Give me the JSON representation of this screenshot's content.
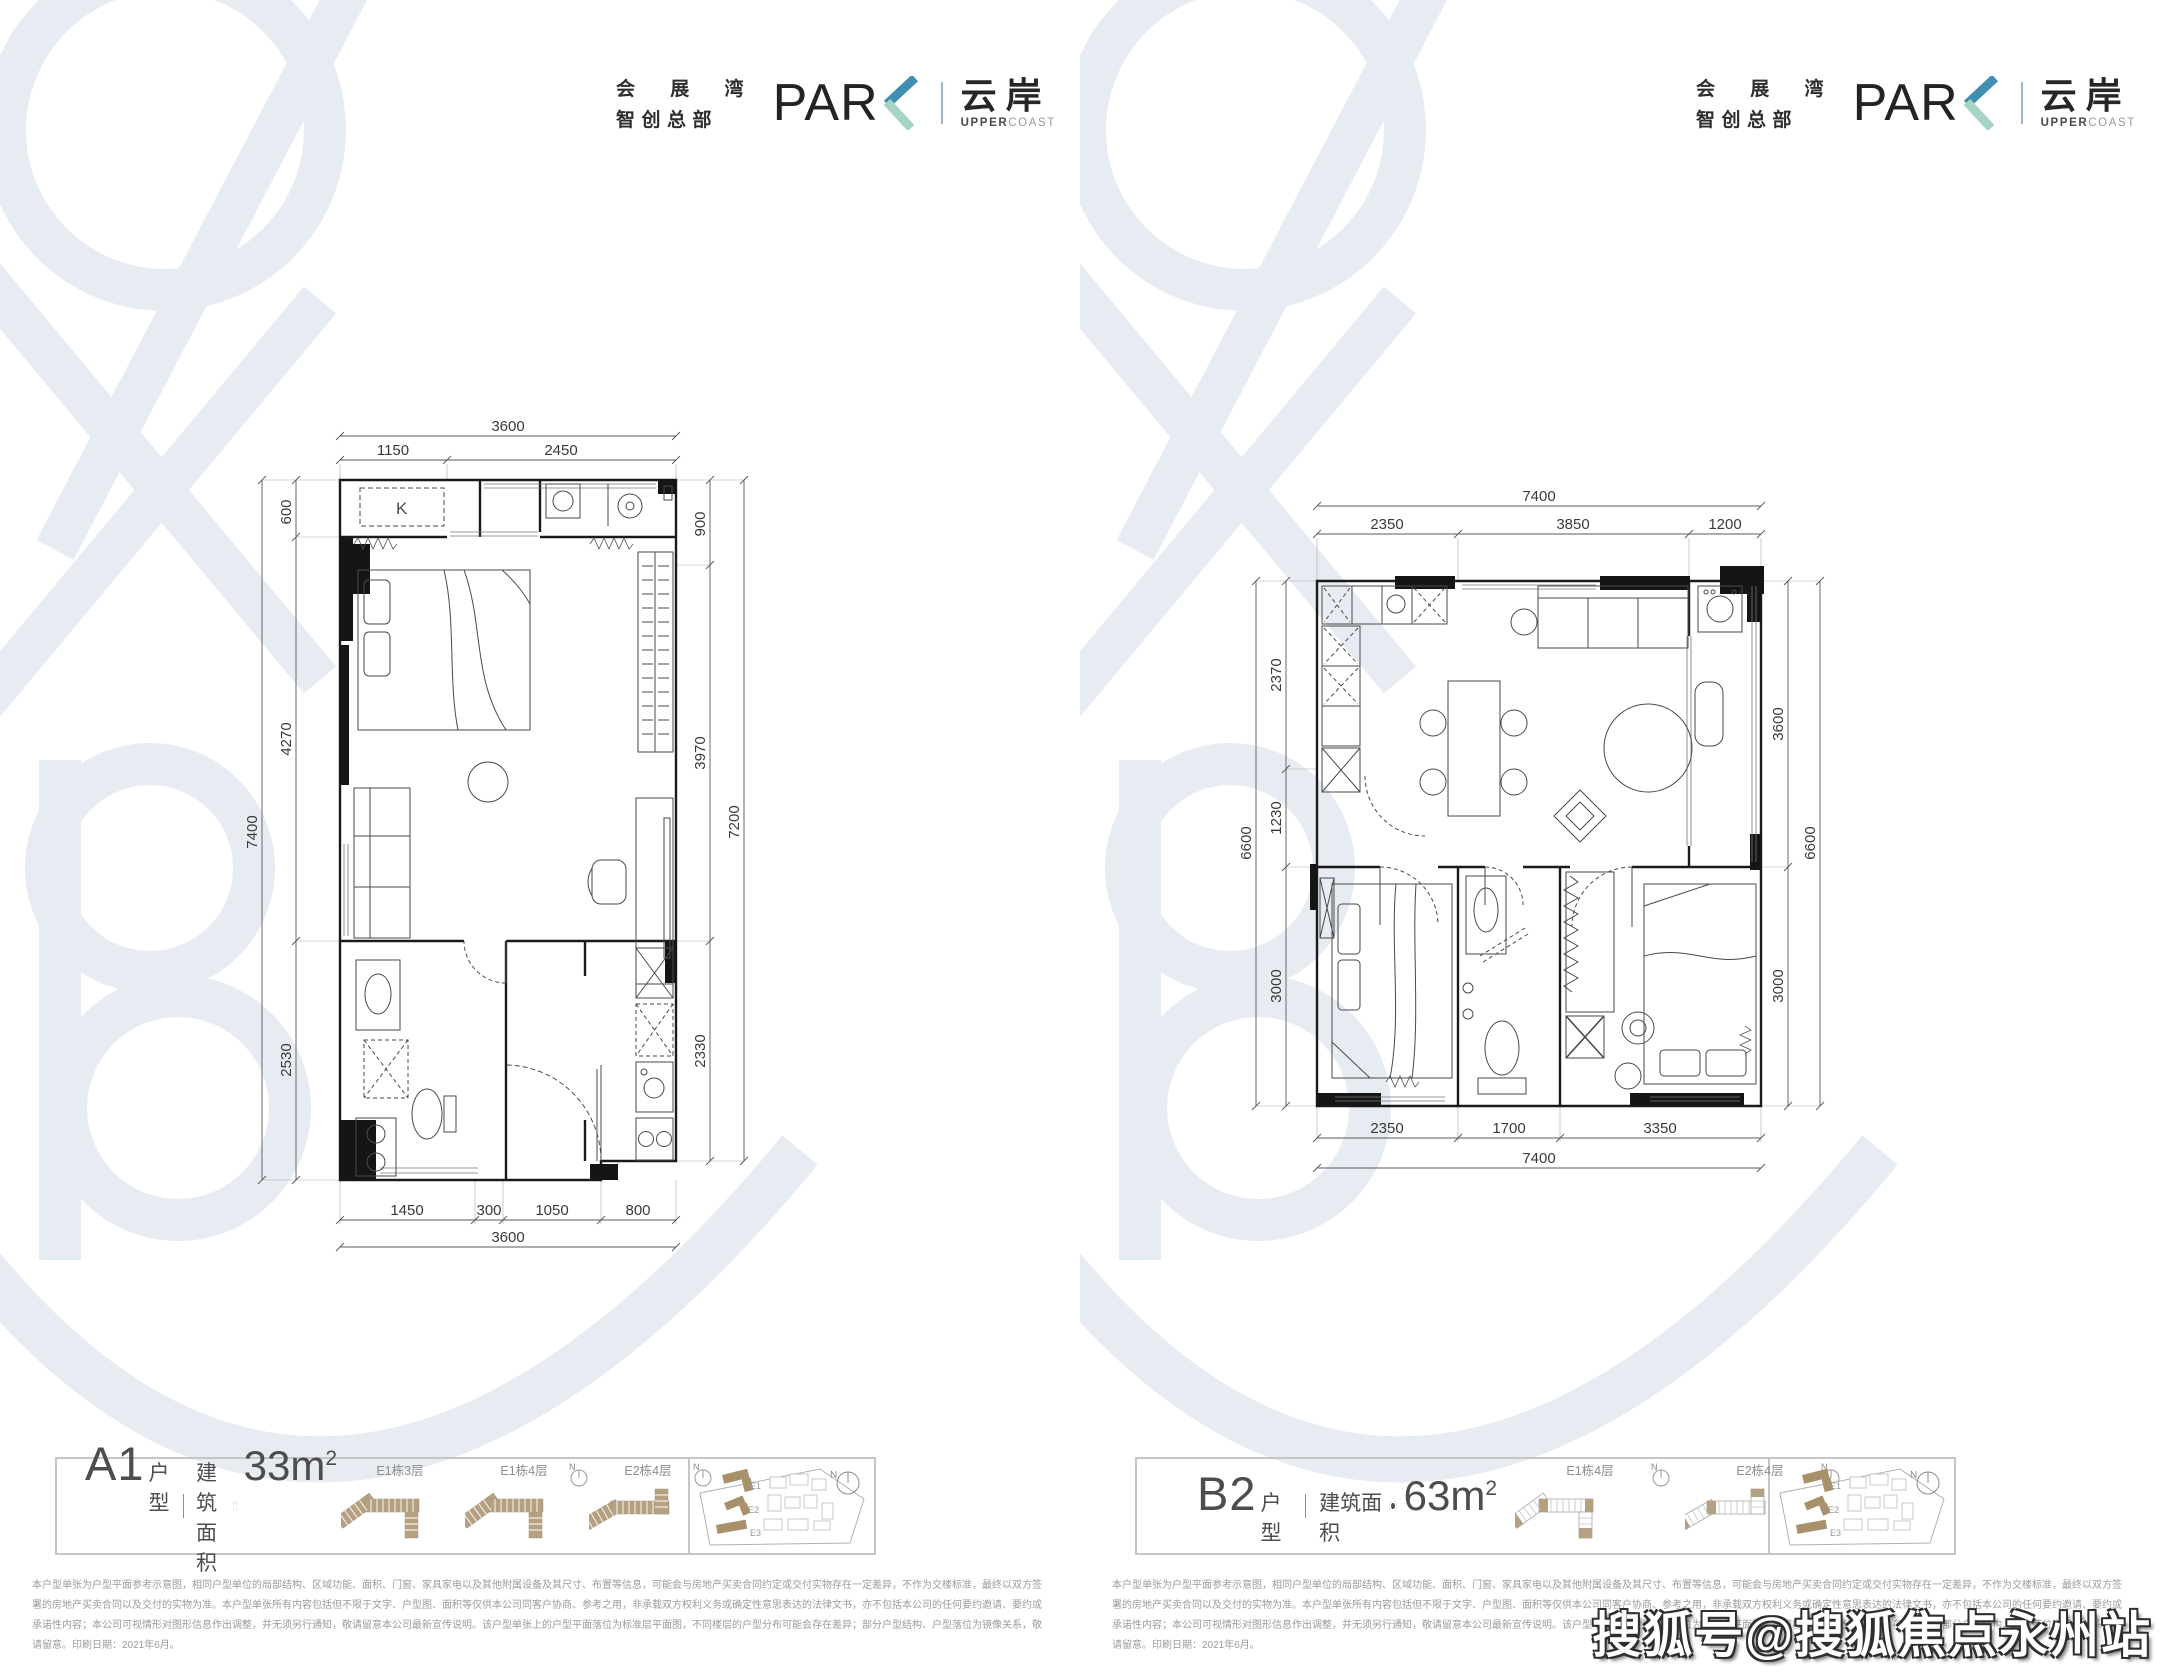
{
  "brand": {
    "cn_top": "会 展 湾",
    "cn_bottom": "智创总部",
    "park_prefix": "PAR",
    "park_k": "K",
    "name_cn": "云岸",
    "en_upper": "UPPER",
    "en_coast": "COAST"
  },
  "watermark": {
    "word": "expo bay",
    "color": "#e7ebf2",
    "sohu": "搜狐号@搜狐焦点永州站"
  },
  "colors": {
    "accent_blue": "#3e8fb0",
    "accent_green": "#a7d4c3",
    "building_tan": "#b5a182",
    "site_building_tan": "#a8906b",
    "dim_text": "#3a3a3a",
    "fine_print": "#9b9b9b"
  },
  "panels": [
    {
      "unit": "A1",
      "unit_suffix": "户型",
      "area_label": "建筑面积",
      "area_value": "33m",
      "area_sup": "2",
      "compass_label": "N",
      "mini_diagrams": [
        {
          "label": "E1栋3层"
        },
        {
          "label": "E1栋4层"
        },
        {
          "label": "E2栋4层"
        }
      ],
      "site": {
        "labels": [
          "E1",
          "E2",
          "E3"
        ]
      },
      "plan": {
        "k_label": "K",
        "top_total": "3600",
        "top_segs": [
          "1150",
          "2450"
        ],
        "left_total": "7400",
        "left_segs": [
          "600",
          "4270",
          "2530"
        ],
        "right_total": "7200",
        "right_segs": [
          "900",
          "3970",
          "2330"
        ],
        "bottom_total": "3600",
        "bottom_segs": [
          "1450",
          "300",
          "1050",
          "800"
        ]
      },
      "disclaimer": "本户型单张为户型平面参考示意图，相同户型单位的局部结构、区域功能、面积、门窗、家具家电以及其他附属设备及其尺寸、布置等信息，可能会与房地产买卖合同约定或交付实物存在一定差异，不作为交楼标准，最终以双方签署的房地产买卖合同以及交付的实物为准。本户型单张所有内容包括但不限于文字、户型图、面积等仅供本公司同客户协商、参考之用，非承载双方权利义务或确定性意思表达的法律文书，亦不包括本公司的任何要约邀请、要约或承诺性内容；本公司可视情形对图形信息作出调整，并无须另行通知，敬请留意本公司最新宣传说明。该户型单张上的户型平面落位为标准层平面图，不同楼层的户型分布可能会存在差异；部分户型结构、户型落位为镜像关系，敬请留意。印刷日期：2021年6月。"
    },
    {
      "unit": "B2",
      "unit_suffix": "户型",
      "area_label": "建筑面积",
      "area_value": "63m",
      "area_sup": "2",
      "compass_label": "N",
      "mini_diagrams": [
        {
          "label": "E1栋4层"
        },
        {
          "label": "E2栋4层"
        }
      ],
      "site": {
        "labels": [
          "E1",
          "E2",
          "E3"
        ]
      },
      "plan": {
        "top_total": "7400",
        "top_segs": [
          "2350",
          "3850",
          "1200"
        ],
        "left_total": "6600",
        "left_segs": [
          "2370",
          "1230",
          "3000"
        ],
        "right_total": "6600",
        "right_segs": [
          "3600",
          "3000"
        ],
        "bottom_total": "7400",
        "bottom_segs": [
          "2350",
          "1700",
          "3350"
        ]
      },
      "disclaimer": "本户型单张为户型平面参考示意图，相同户型单位的局部结构、区域功能、面积、门窗、家具家电以及其他附属设备及其尺寸、布置等信息，可能会与房地产买卖合同约定或交付实物存在一定差异，不作为交楼标准，最终以双方签署的房地产买卖合同以及交付的实物为准。本户型单张所有内容包括但不限于文字、户型图、面积等仅供本公司同客户协商、参考之用，非承载双方权利义务或确定性意思表达的法律文书，亦不包括本公司的任何要约邀请、要约或承诺性内容；本公司可视情形对图形信息作出调整，并无须另行通知，敬请留意本公司最新宣传说明。该户型单张上的户型平面落位为标准层平面图，不同楼层的户型分布可能会存在差异；部分户型结构、户型落位为镜像关系，敬请留意。印刷日期：2021年6月。"
    }
  ]
}
